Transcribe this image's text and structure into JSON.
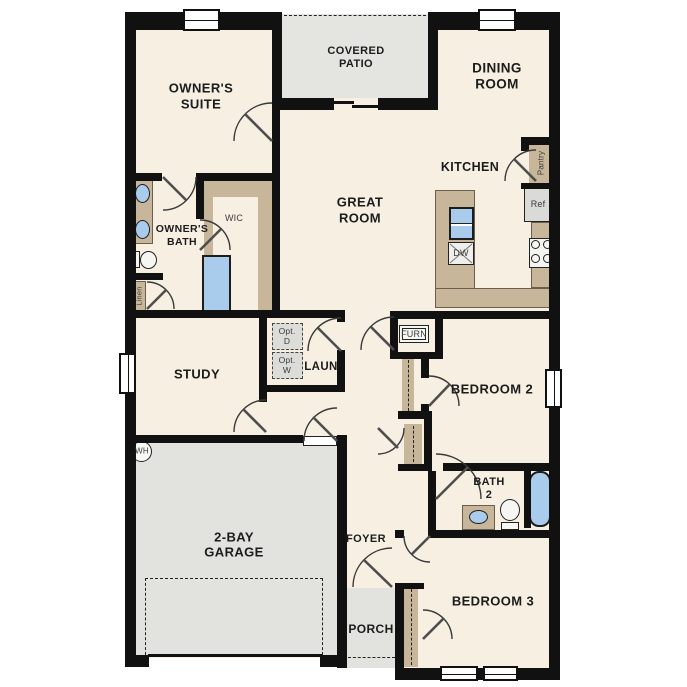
{
  "plan_colors": {
    "wall": "#111111",
    "floor": "#F6EFE2",
    "tan": "#C8B69B",
    "gray": "#E2E2DE",
    "blue": "#A9CBEC",
    "outside": "#FFFFFF"
  },
  "rooms": {
    "owners_suite": {
      "line1": "OWNER'S",
      "line2": "SUITE"
    },
    "covered_patio": {
      "line1": "COVERED",
      "line2": "PATIO"
    },
    "dining_room": {
      "line1": "DINING",
      "line2": "ROOM"
    },
    "kitchen": {
      "line1": "KITCHEN"
    },
    "great_room": {
      "line1": "GREAT",
      "line2": "ROOM"
    },
    "owners_bath": {
      "line1": "OWNER'S",
      "line2": "BATH"
    },
    "wic": {
      "line1": "WIC"
    },
    "study": {
      "line1": "STUDY"
    },
    "laundry": {
      "line1": "LAUN"
    },
    "bedroom_2": {
      "line1": "BEDROOM 2"
    },
    "bath_2": {
      "line1": "BATH",
      "line2": "2"
    },
    "bedroom_3": {
      "line1": "BEDROOM 3"
    },
    "garage": {
      "line1": "2-BAY",
      "line2": "GARAGE"
    },
    "foyer": {
      "line1": "FOYER"
    },
    "porch": {
      "line1": "PORCH"
    }
  },
  "fixtures": {
    "pantry": "Pantry",
    "refrigerator": "Ref",
    "dishwasher": "DW",
    "furnace": "FURN",
    "linen": "Linen",
    "water_heater": "WH",
    "opt_dryer": {
      "line1": "Opt.",
      "line2": "D"
    },
    "opt_washer": {
      "line1": "Opt.",
      "line2": "W"
    }
  }
}
